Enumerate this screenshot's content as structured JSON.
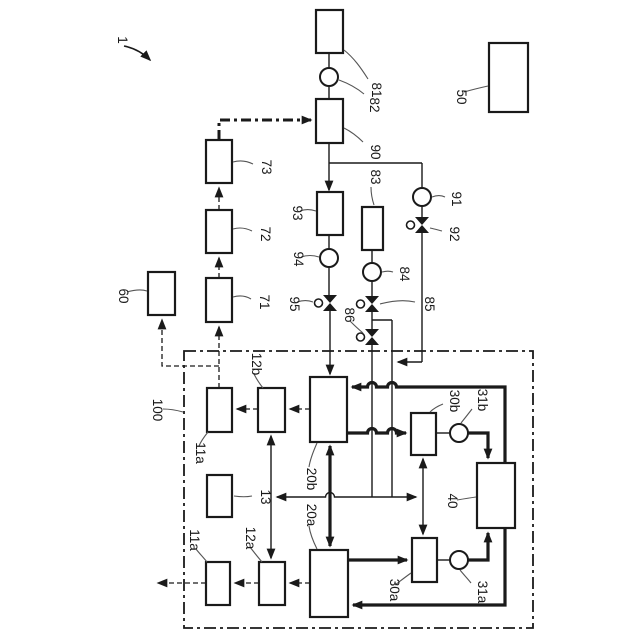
{
  "ink": "#1a1a1a",
  "background": "#ffffff",
  "labels": {
    "n1": "1",
    "n50": "50",
    "n60": "60",
    "n71": "71",
    "n72": "72",
    "n73": "73",
    "n81": "81",
    "n82": "82",
    "n83": "83",
    "n84": "84",
    "n85": "85",
    "n86": "86",
    "n90": "90",
    "n91": "91",
    "n92": "92",
    "n93": "93",
    "n94": "94",
    "n95": "95",
    "n100": "100",
    "n11a_top": "11a",
    "n11a_bottom": "11a",
    "n12a": "12a",
    "n12b": "12b",
    "n13": "13",
    "n20a": "20a",
    "n20b": "20b",
    "n30a": "30a",
    "n30b": "30b",
    "n31a": "31a",
    "n31b": "31b",
    "n40": "40"
  }
}
